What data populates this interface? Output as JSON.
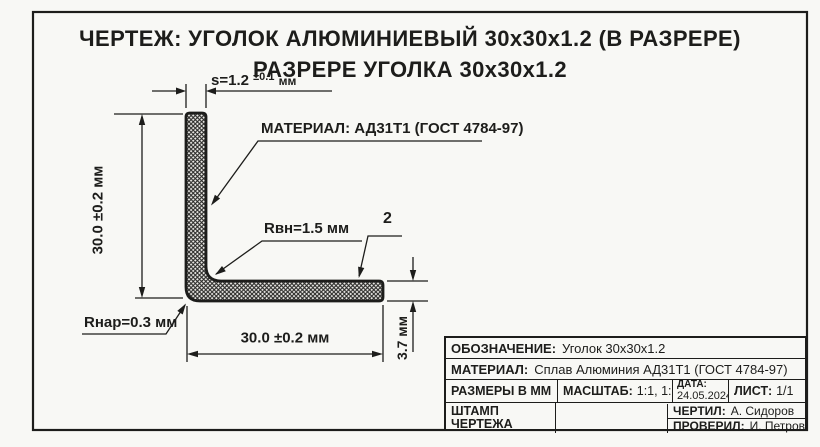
{
  "colors": {
    "ink": "#1d1d1b",
    "paper": "#f8f8f5"
  },
  "title": {
    "line1": "ЧЕРТЕЖ: УГОЛОК АЛЮМИНИЕВЫЙ 30x30x1.2 (В РАЗРЕРЕ)",
    "line2": "РАЗРЕРЕ УГОЛКА 30x30x1.2"
  },
  "dimensions": {
    "wall_thickness": {
      "value": "s=1.2",
      "tolerance": "±0.1",
      "unit": "мм"
    },
    "height": "30.0 ±0.2 мм",
    "width": "30.0 ±0.2 мм",
    "flange_thickness": "3.7 мм"
  },
  "callouts": {
    "material": "МАТЕРИАЛ: АД31Т1 (ГОСТ 4784-97)",
    "inner_radius": "Rвн=1.5 мм",
    "outer_radius": "Rнар=0.3 мм",
    "item_number": "2"
  },
  "title_block": {
    "designation": {
      "label": "ОБОЗНАЧЕНИЕ:",
      "value": "Уголок 30x30x1.2"
    },
    "material": {
      "label": "МАТЕРИАЛ:",
      "value": "Сплав Алюминия АД31Т1 (ГОСТ 4784-97)"
    },
    "units": "РАЗМЕРЫ В ММ",
    "scale": {
      "label": "МАСШТАБ:",
      "value": "1:1, 1:2"
    },
    "date": {
      "label": "ДАТА:",
      "value": "24.05.2024"
    },
    "sheet": {
      "label": "ЛИСТ:",
      "value": "1/1"
    },
    "stamp": {
      "line1": "ШТАМП",
      "line2": "ЧЕРТЕЖА"
    },
    "drawn": {
      "label": "ЧЕРТИЛ:",
      "value": "А. Сидоров"
    },
    "checked": {
      "label": "ПРОВЕРИЛ:",
      "value": "И. Петров"
    }
  }
}
